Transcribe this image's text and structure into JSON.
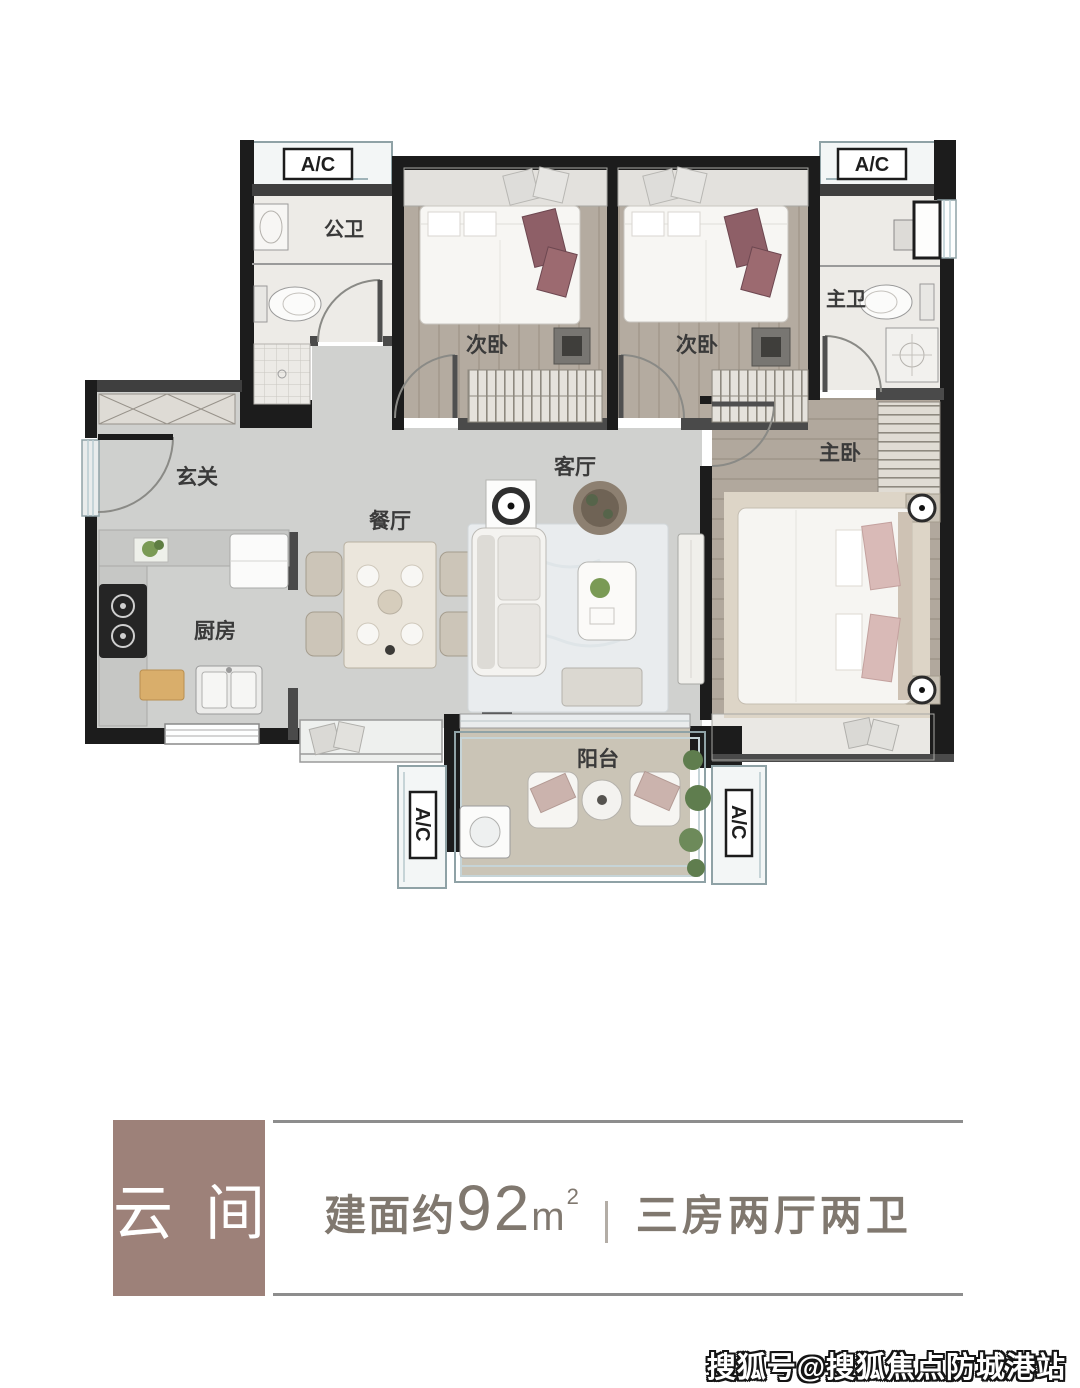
{
  "floorplan": {
    "ac_label": "A/C",
    "rooms": {
      "public_bath": "公卫",
      "bedroom_a": "次卧",
      "bedroom_b": "次卧",
      "master_bath": "主卫",
      "master_bedroom": "主卧",
      "entry": "玄关",
      "kitchen": "厨房",
      "dining": "餐厅",
      "living": "客厅",
      "balcony": "阳台"
    }
  },
  "info_panel": {
    "unit_name": "云间",
    "area_prefix": "建面约",
    "area_value": "92",
    "area_unit": "m",
    "area_exponent": "2",
    "layout_text": "三房两厅两卫"
  },
  "watermark": {
    "text": "搜狐号@搜狐焦点防城港站"
  },
  "colors": {
    "accent_brown": "#9d8179",
    "spec_text": "#80786f",
    "wall_black": "#1c1c1c",
    "wall_gray": "#4a4a4a",
    "wood_floor": "#b4aba0",
    "marble_floor": "#edebe7",
    "living_floor": "#d0d1cf",
    "balcony_floor": "#cac4b6",
    "maroon_pillow": "#8e5f67",
    "pink_pillow": "#d9bab7",
    "ac_trim": "#8fa2a6",
    "rule_gray": "#8d8d8d"
  }
}
